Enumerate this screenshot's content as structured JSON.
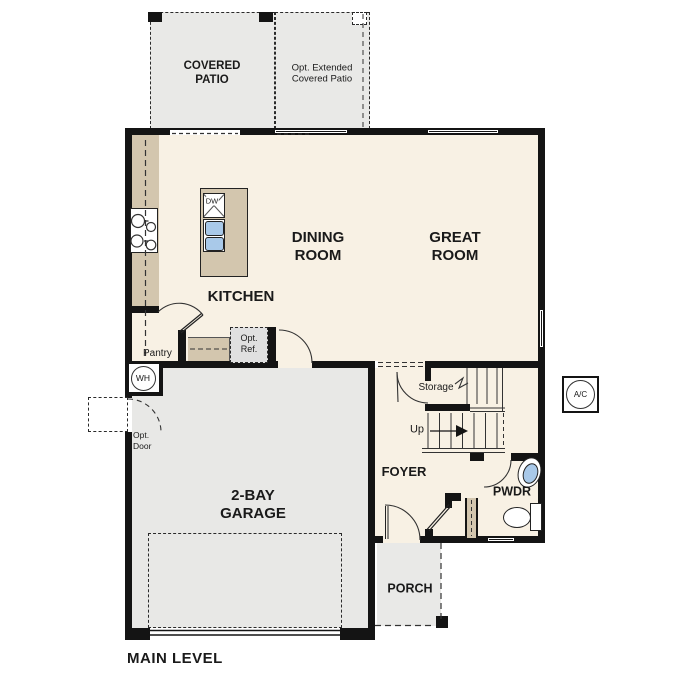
{
  "title": "MAIN LEVEL",
  "rooms": {
    "covered_patio_l1": "COVERED",
    "covered_patio_l2": "PATIO",
    "ext_patio_l1": "Opt. Extended",
    "ext_patio_l2": "Covered Patio",
    "dining_l1": "DINING",
    "dining_l2": "ROOM",
    "great_l1": "GREAT",
    "great_l2": "ROOM",
    "kitchen": "KITCHEN",
    "garage_l1": "2-BAY",
    "garage_l2": "GARAGE",
    "foyer": "FOYER",
    "pwdr": "PWDR",
    "porch": "PORCH"
  },
  "annotations": {
    "pantry": "Pantry",
    "opt_ref_l1": "Opt.",
    "opt_ref_l2": "Ref.",
    "storage": "Storage",
    "up": "Up",
    "opt_door_l1": "Opt.",
    "opt_door_l2": "Door",
    "wh": "WH",
    "ac": "A/C",
    "dw": "DW"
  },
  "colors": {
    "interior_floor": "#f8f1e4",
    "garage_floor": "#e8e8e6",
    "patio_floor": "#e9e9e7",
    "counter_tan": "#d3c6ae",
    "wall_black": "#141414",
    "fixture_blue": "#a9c9e9",
    "opt_ref_gray": "#e0e0e0"
  }
}
